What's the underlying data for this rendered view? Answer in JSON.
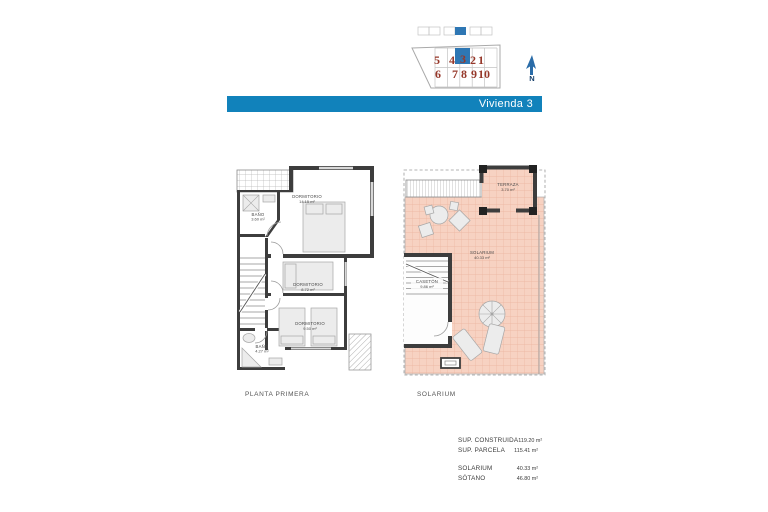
{
  "banner": {
    "title": "Vivienda 3"
  },
  "site_plan": {
    "top_row": [
      "5",
      "4",
      "3",
      "2",
      "1"
    ],
    "bottom_row": [
      "6",
      "7",
      "8",
      "9",
      "10"
    ],
    "highlighted_unit": "3",
    "north_label": "N"
  },
  "plans": {
    "left": {
      "caption": "PLANTA PRIMERA",
      "rooms": [
        {
          "name": "DORMITORIO",
          "area": "14.15 m²"
        },
        {
          "name": "BAÑO",
          "area": "3.60 m²"
        },
        {
          "name": "DORMITORIO",
          "area": "8.72 m²"
        },
        {
          "name": "DORMITORIO",
          "area": "9.50 m²"
        },
        {
          "name": "BAÑO",
          "area": "4.27 m²"
        }
      ]
    },
    "right": {
      "caption": "SOLARIUM",
      "rooms": [
        {
          "name": "TERRAZA",
          "area": "3.70 m²"
        },
        {
          "name": "SOLARIUM",
          "area": "40.33 m²"
        },
        {
          "name": "CASETÓN",
          "area": "9.86 m²"
        }
      ]
    }
  },
  "summary": {
    "rows": [
      {
        "label": "SUP. CONSTRUIDA",
        "value": "119.20 m²"
      },
      {
        "label": "SUP. PARCELA",
        "value": "115.41 m²"
      },
      {
        "label": "SOLARIUM",
        "value": "40.33 m²"
      },
      {
        "label": "SÓTANO",
        "value": "46.80 m²"
      }
    ]
  },
  "colors": {
    "banner_blue": "#1182bb",
    "site_highlight": "#2e77b4",
    "unit_red": "#96382a",
    "wall_gray": "#3d3d3d",
    "solarium_fill": "#f7d2c2",
    "solarium_grid": "#ecb49e"
  }
}
